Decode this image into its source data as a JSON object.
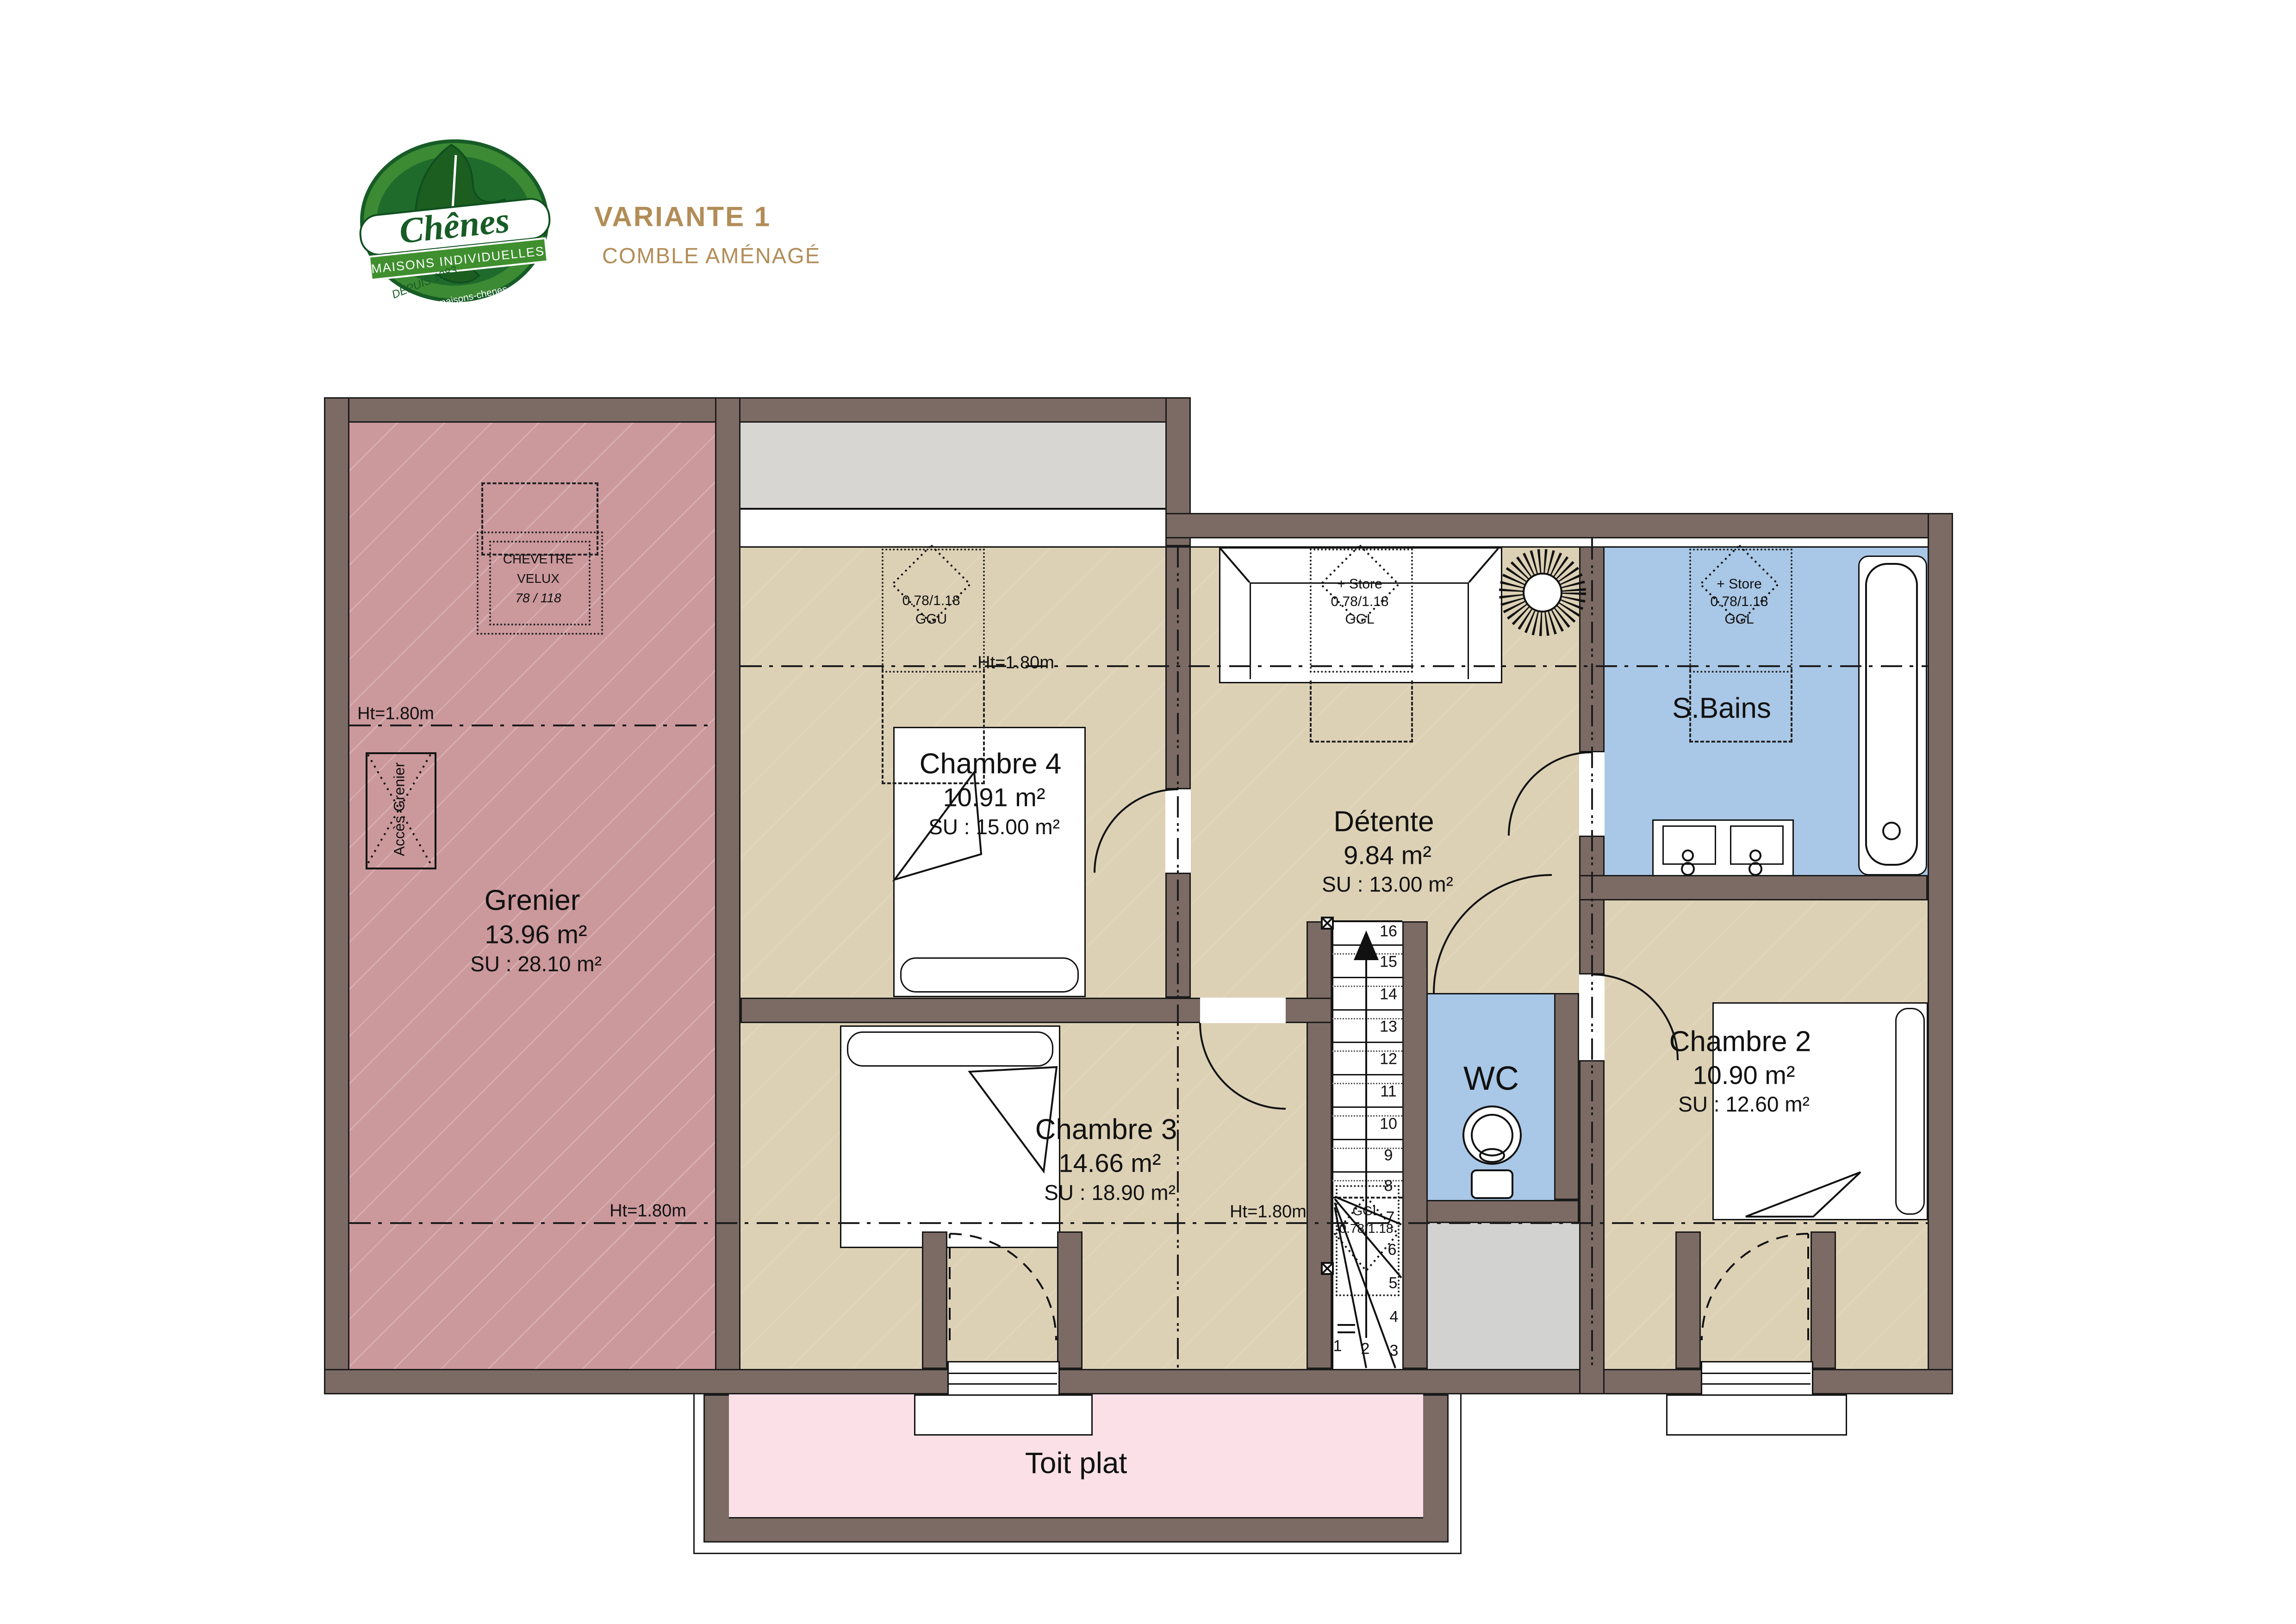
{
  "logo": {
    "brand": "Chênes",
    "tagline": "MAISONS INDIVIDUELLES",
    "since": "DEPUIS 1983",
    "site": "www.maisons-chenes.com"
  },
  "header": {
    "title": "VARIANTE 1",
    "subtitle": "COMBLE AMÉNAGÉ"
  },
  "rooms": {
    "grenier": {
      "name": "Grenier",
      "area": "13.96 m²",
      "su": "SU : 28.10 m²"
    },
    "chambre4": {
      "name": "Chambre 4",
      "area": "10.91 m²",
      "su": "SU : 15.00 m²"
    },
    "detente": {
      "name": "Détente",
      "area": "9.84 m²",
      "su": "SU : 13.00 m²"
    },
    "sbains": {
      "name": "S.Bains"
    },
    "chambre3": {
      "name": "Chambre 3",
      "area": "14.66 m²",
      "su": "SU : 18.90 m²"
    },
    "chambre2": {
      "name": "Chambre 2",
      "area": "10.90 m²",
      "su": "SU : 12.60 m²"
    },
    "wc": {
      "name": "WC"
    },
    "toit": {
      "name": "Toit plat"
    }
  },
  "annotations": {
    "ht": "Ht=1.80m",
    "chevetre1": "CHEVETRE",
    "chevetre2": "VELUX",
    "chevetre3": "78 / 118",
    "acces": "Accès Grenier",
    "ggu1": "0.78/1.18",
    "ggu2": "GGU",
    "store1": "+ Store",
    "store2": "0.78/1.18",
    "store3": "GGL",
    "stair_ggl1": "GGL",
    "stair_ggl2": "0.78/1.18"
  },
  "stairs": {
    "numbers": [
      "1",
      "2",
      "3",
      "4",
      "5",
      "6",
      "7",
      "8",
      "9",
      "10",
      "11",
      "12",
      "13",
      "14",
      "15",
      "16"
    ]
  },
  "colors": {
    "wall": "#7b6b64",
    "floor": "#ddd1b5",
    "grenier": "#cb989c",
    "water": "#a9c7e6",
    "toit_plat": "#fbe0e8",
    "roof_gray": "#d7d6d3",
    "landing_gray": "#d2d2d0",
    "accent": "#b28d58",
    "logo_green": "#2e7d32"
  }
}
